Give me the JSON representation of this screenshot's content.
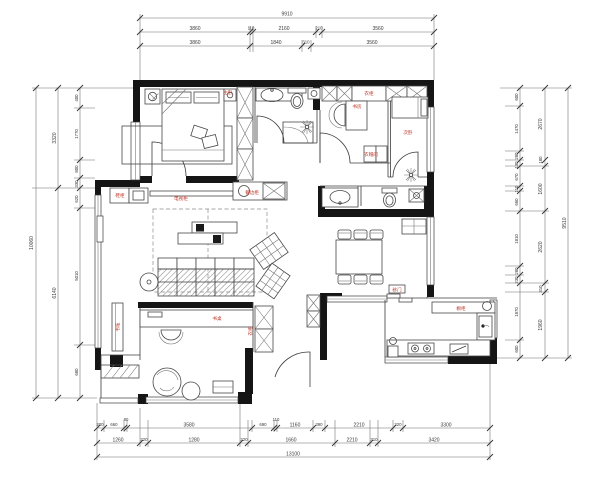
{
  "drawing": {
    "type": "residential floor plan (CAD)",
    "accent_red": "#c0392b",
    "line_color": "#3c3c3c",
    "wall_color": "#151515"
  },
  "dims": {
    "top": {
      "total": "9910",
      "row2": [
        "3860",
        "110",
        "2160",
        "210",
        "3560"
      ],
      "row3": [
        "3860",
        "1840",
        "310",
        "3560"
      ]
    },
    "left": {
      "total": "10060",
      "mid": [
        "3320",
        "6140"
      ],
      "inner": [
        "400",
        "1770",
        "800",
        "330",
        "620",
        "5010",
        "680"
      ]
    },
    "right": {
      "total": "9510",
      "mid": [
        "2670",
        "180",
        "1600",
        "2620",
        "310",
        "1960"
      ],
      "inner": [
        "600",
        "1470",
        "280",
        "130",
        "670",
        "110",
        "660",
        "1810",
        "280",
        "230",
        "1870",
        "600"
      ]
    },
    "bottom": {
      "total": "13100",
      "row1": [
        "200",
        "660",
        "80",
        "3580",
        "690",
        "110",
        "1160",
        "390",
        "2210",
        "320",
        "3300"
      ],
      "row2": [
        "1260",
        "220",
        "1280",
        "220",
        "1660",
        "2210",
        "310",
        "3420"
      ]
    }
  },
  "labels": {
    "master_bedroom": "主卧",
    "wardrobe_top": "衣柜",
    "study": "书房",
    "bedroom2": "次卧",
    "walkin_closet": "衣帽间",
    "shoe_cabinet": "鞋柜",
    "tv_console": "电视柜",
    "sideboard": "餐边柜",
    "desk": "书桌",
    "bookshelf": "书柜",
    "wardrobe_side": "衣柜",
    "kitchen_cabinet": "橱柜",
    "kitchen_door": "移门"
  }
}
